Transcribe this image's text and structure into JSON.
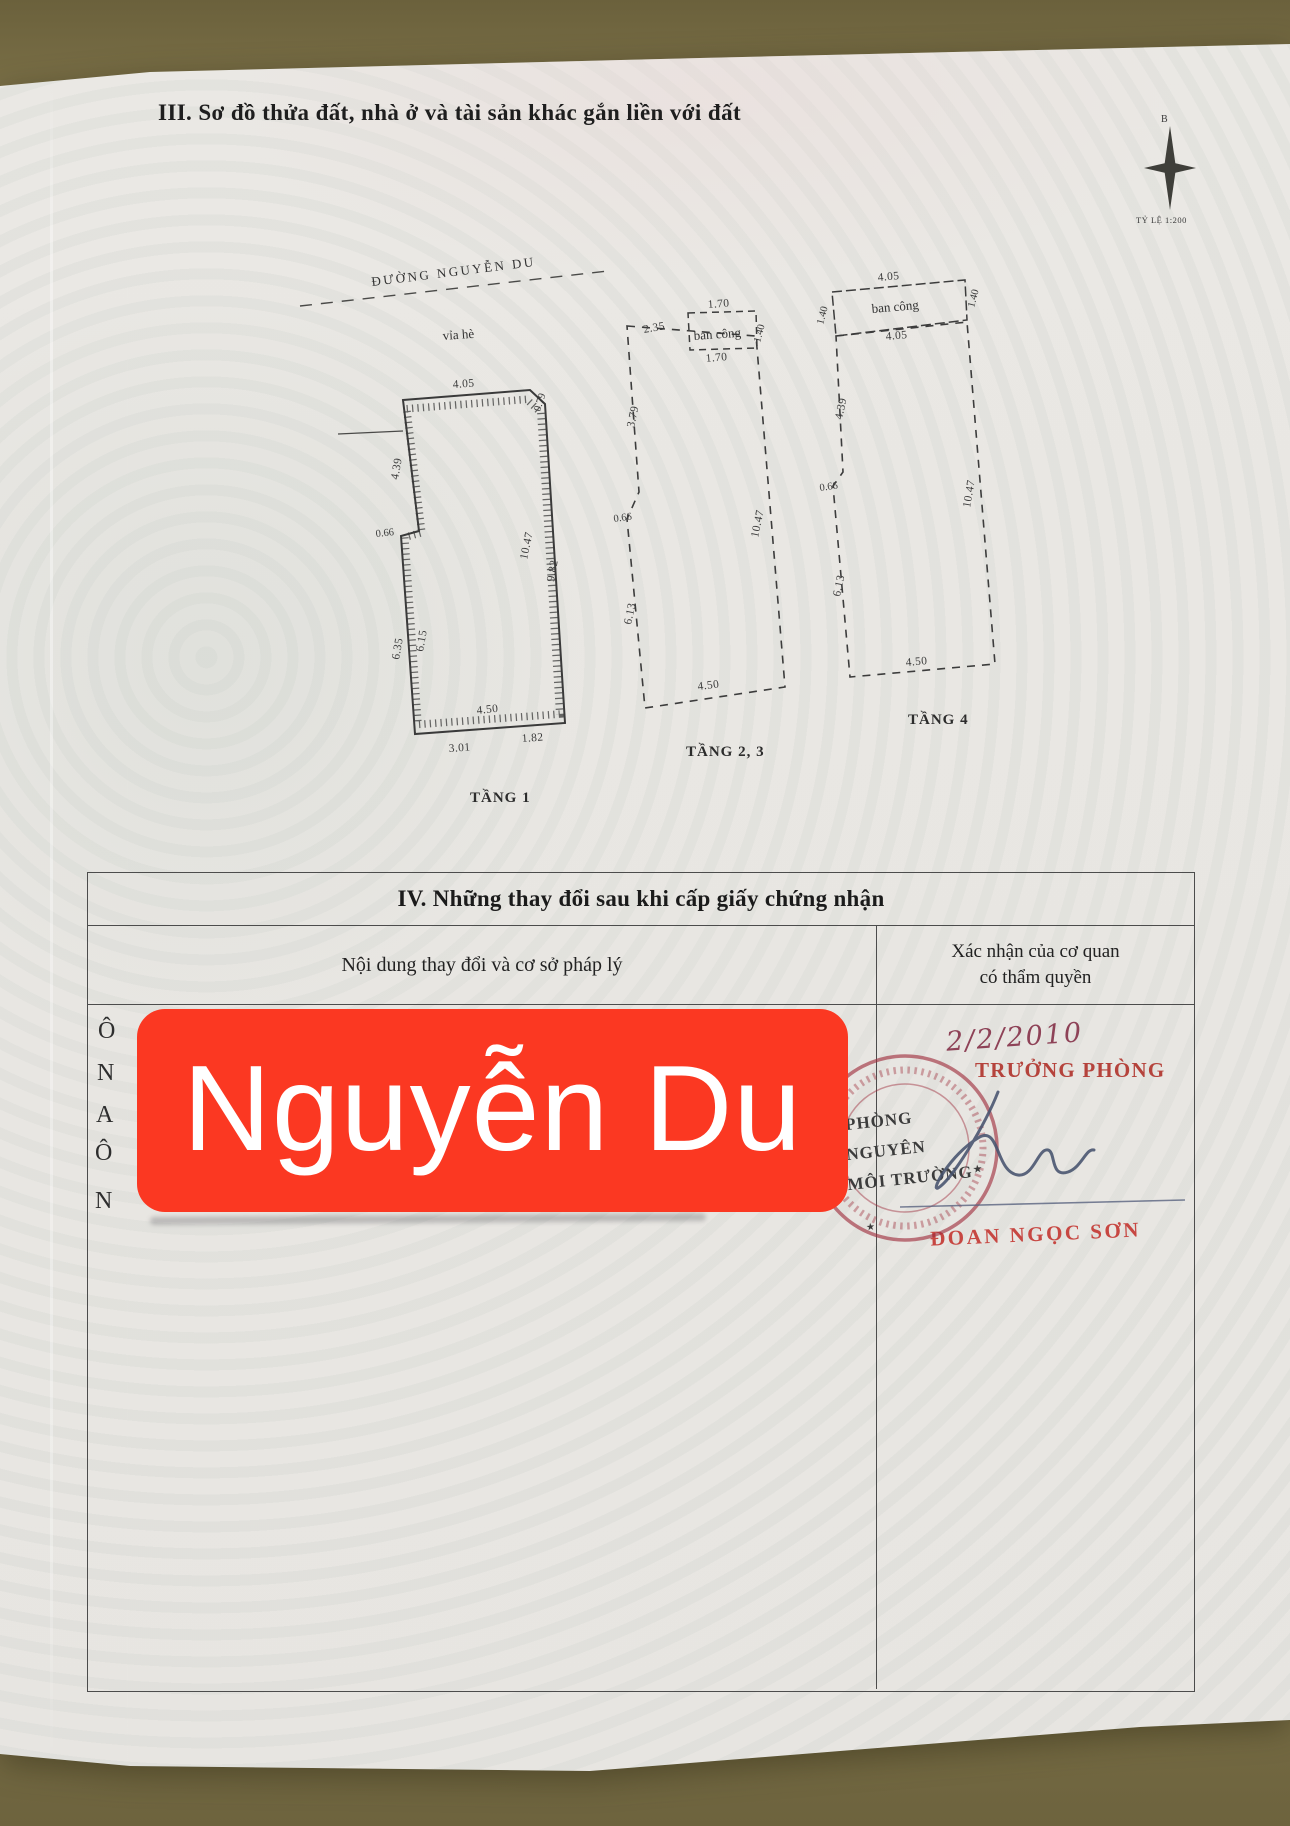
{
  "document": {
    "section3_title": "III. Sơ đồ thửa đất, nhà ở và tài sản khác gắn liền với đất",
    "compass": {
      "north_label": "B",
      "scale_label": "TỶ LỆ 1:200"
    },
    "site": {
      "street_label": "ĐƯỜNG NGUYỄN DU",
      "sidewalk_label": "vỉa hè"
    }
  },
  "plans": {
    "plan1": {
      "caption": "TẦNG 1",
      "dims": {
        "top": "4.05",
        "top_right": "0.79",
        "left_upper": "4.39",
        "left_step": "0.66",
        "left_lower_inner": "6.15",
        "left_lower_outer": "6.35",
        "right_inner": "10.47",
        "right_outer": "9.82",
        "bottom": "4.50",
        "bottom_left": "3.01",
        "bottom_right": "1.82"
      }
    },
    "plan2": {
      "caption": "TẦNG 2, 3",
      "balcony_label": "ban công",
      "dims": {
        "balcony_top": "1.70",
        "balcony_left": "2.35",
        "balcony_right": "1.40",
        "balcony_bottom": "1.70",
        "left_upper": "3.79",
        "left_step": "0.66",
        "left_lower": "6.13",
        "right": "10.47",
        "bottom": "4.50"
      }
    },
    "plan3": {
      "caption": "TẦNG 4",
      "balcony_label": "ban công",
      "dims": {
        "balcony_top": "4.05",
        "balcony_left": "1.40",
        "balcony_right": "1.40",
        "balcony_bottom": "4.05",
        "left_upper": "4.39",
        "left_step": "0.66",
        "left_lower": "6.13",
        "right": "10.47",
        "bottom": "4.50"
      }
    }
  },
  "section4": {
    "title": "IV. Những thay đổi sau khi cấp giấy chứng nhận",
    "col1_header": "Nội dung thay đổi và cơ sở pháp lý",
    "col2_header": {
      "line1": "Xác nhận của cơ quan",
      "line2": "có thẩm quyền"
    },
    "covered_line_starts": [
      "Ô",
      "N",
      "A",
      "Ô",
      "N"
    ],
    "overlay": {
      "label": "Nguyễn Du",
      "color": "#fb3822"
    },
    "approval": {
      "date": "2/2/2010",
      "approver_title": "TRƯỞNG PHÒNG",
      "approver_name": "ĐOAN NGỌC SƠN",
      "stamp": {
        "line1": "PHÒNG",
        "line2": "NGUYÊN",
        "line3": "MÔI TRƯỜNG",
        "star_glyph": "★"
      }
    }
  },
  "colors": {
    "paper": "#eae8e4",
    "wood": "#7a6f46",
    "ink": "#2b2b2b",
    "stamp_red": "#a63246",
    "overlay_red": "#fb3822"
  }
}
